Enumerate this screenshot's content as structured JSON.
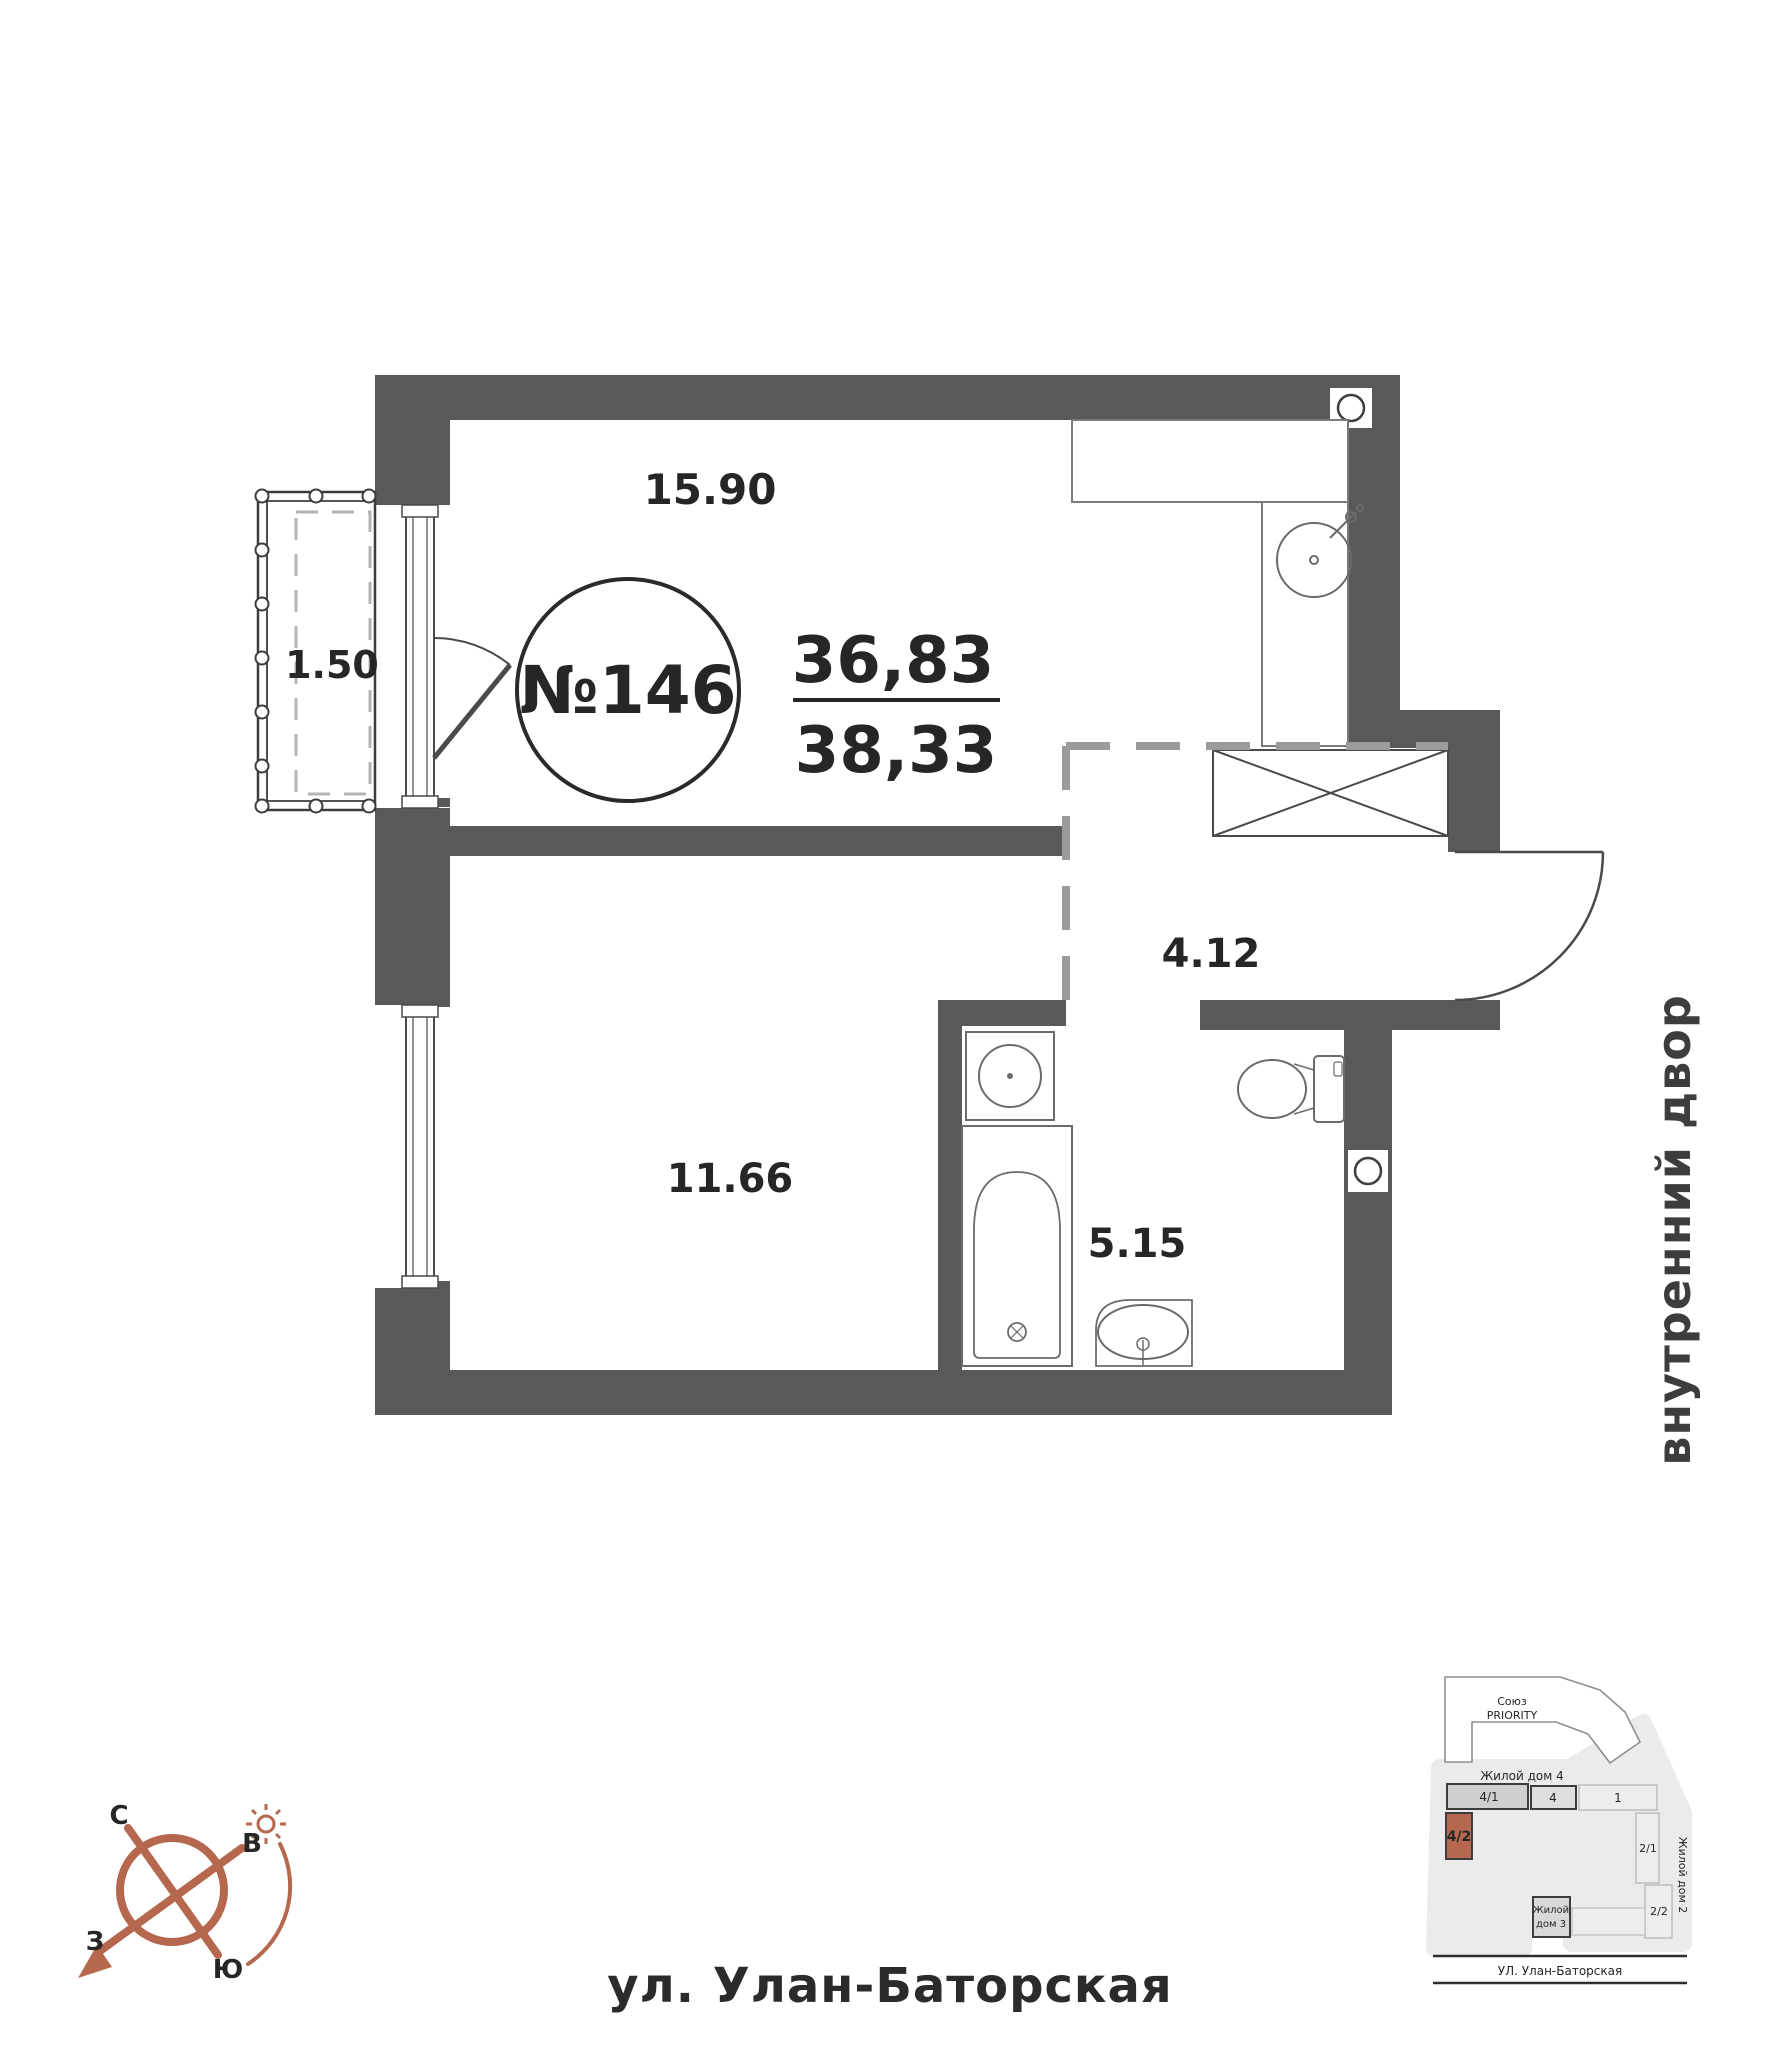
{
  "plan": {
    "apartment_number": "№146",
    "area_living": "36,83",
    "area_total": "38,33",
    "areas": {
      "living_kitchen": "15.90",
      "balcony": "1.50",
      "bedroom": "11.66",
      "hallway": "4.12",
      "bathroom": "5.15"
    },
    "labels": {
      "courtyard": "внутренний двор",
      "street": "ул. Улан-Баторская"
    }
  },
  "compass": {
    "north": "С",
    "east": "В",
    "west": "З",
    "south": "Ю"
  },
  "site_plan": {
    "complex_line1": "Союз",
    "complex_line2": "PRIORITY",
    "house4_label": "Жилой дом 4",
    "house2_label": "Жилой дом 2",
    "house3_line1": "Жилой",
    "house3_line2": "дом 3",
    "blocks": {
      "b41": "4/1",
      "b4": "4",
      "b1": "1",
      "b21": "2/1",
      "b22": "2/2",
      "b42": "4/2"
    },
    "street_label": "УЛ. Улан-Баторская"
  },
  "colors": {
    "wall": "#58595b",
    "dash": "#9b9b9b",
    "accent": "#b5684e",
    "site_bg": "#ebebeb",
    "highlight_block": "#b5674f"
  }
}
